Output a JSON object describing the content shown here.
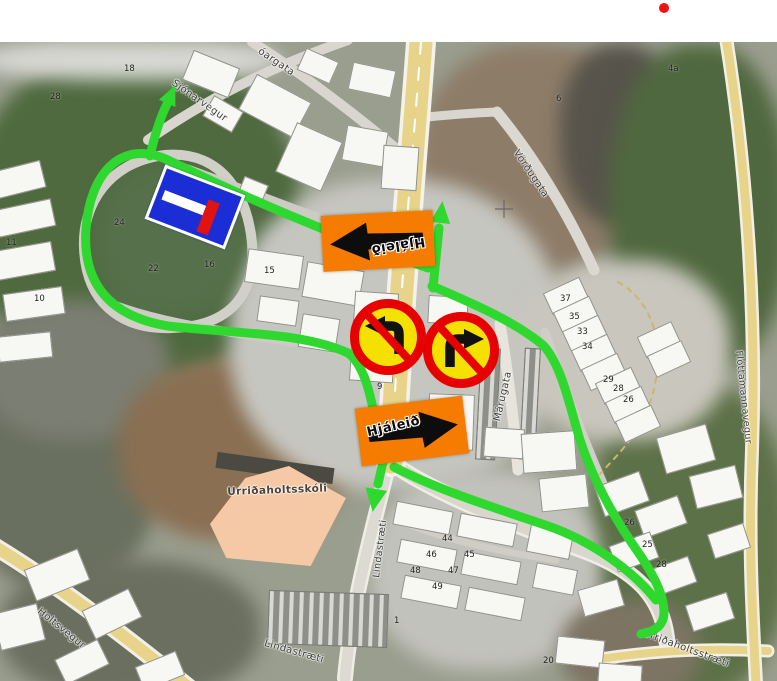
{
  "map_title": "Urriðaholt detour map",
  "colors": {
    "route_green": "#2fd82f",
    "road_yellow": "#e7d48a",
    "sign_orange": "#f57c00",
    "prohibition_yellow": "#f5e100",
    "prohibition_red": "#e60000",
    "dead_end_blue": "#1b2ed6",
    "dead_end_red": "#e01212",
    "school_fill": "#f6c9a6",
    "marker_red": "#ee1111"
  },
  "signs": {
    "detour_label": "Hjáleið",
    "prohibition": [
      {
        "name": "no-left-turn-sign"
      },
      {
        "name": "no-right-turn-sign"
      }
    ],
    "dead_end": {
      "name": "no-through-road-sign"
    }
  },
  "street_labels": [
    {
      "text": "Sjónarvegur",
      "x": 176,
      "y": 78,
      "rot": 35,
      "size": 10
    },
    {
      "text": "óargata",
      "x": 262,
      "y": 46,
      "rot": 34,
      "size": 10
    },
    {
      "text": "Vörðugata",
      "x": 520,
      "y": 148,
      "rot": 56,
      "size": 10
    },
    {
      "text": "Flóttamannavegur",
      "x": 744,
      "y": 350,
      "rot": 84,
      "size": 9.5
    },
    {
      "text": "Márugata",
      "x": 492,
      "y": 420,
      "rot": -77,
      "size": 10
    },
    {
      "text": "Urriðaholtsskóli",
      "x": 227,
      "y": 486,
      "rot": -2,
      "size": 10.5,
      "color": "#4c4238",
      "weight": "bold"
    },
    {
      "text": "Lindastræti",
      "x": 371,
      "y": 577,
      "rot": -83,
      "size": 9.5
    },
    {
      "text": "Lindastræti",
      "x": 266,
      "y": 638,
      "rot": 16,
      "size": 10
    },
    {
      "text": "Holtsvegur",
      "x": 42,
      "y": 606,
      "rot": 39,
      "size": 10
    },
    {
      "text": "Urriðaholtsstræti",
      "x": 645,
      "y": 628,
      "rot": 20,
      "size": 10
    }
  ],
  "building_numbers": [
    {
      "text": "18",
      "x": 124,
      "y": 64
    },
    {
      "text": "28",
      "x": 50,
      "y": 92
    },
    {
      "text": "24",
      "x": 114,
      "y": 218
    },
    {
      "text": "22",
      "x": 148,
      "y": 264
    },
    {
      "text": "16",
      "x": 204,
      "y": 260
    },
    {
      "text": "15",
      "x": 264,
      "y": 266
    },
    {
      "text": "11",
      "x": 6,
      "y": 238
    },
    {
      "text": "10",
      "x": 34,
      "y": 294
    },
    {
      "text": "4a",
      "x": 668,
      "y": 64
    },
    {
      "text": "6",
      "x": 556,
      "y": 94
    },
    {
      "text": "9",
      "x": 377,
      "y": 382
    },
    {
      "text": "18",
      "x": 449,
      "y": 406
    },
    {
      "text": "37",
      "x": 560,
      "y": 294
    },
    {
      "text": "35",
      "x": 569,
      "y": 312
    },
    {
      "text": "33",
      "x": 577,
      "y": 327
    },
    {
      "text": "34",
      "x": 582,
      "y": 342
    },
    {
      "text": "29",
      "x": 603,
      "y": 375
    },
    {
      "text": "28",
      "x": 613,
      "y": 384
    },
    {
      "text": "26",
      "x": 623,
      "y": 395
    },
    {
      "text": "44",
      "x": 442,
      "y": 534
    },
    {
      "text": "46",
      "x": 426,
      "y": 550
    },
    {
      "text": "48",
      "x": 410,
      "y": 566
    },
    {
      "text": "45",
      "x": 464,
      "y": 550
    },
    {
      "text": "47",
      "x": 448,
      "y": 566
    },
    {
      "text": "49",
      "x": 432,
      "y": 582
    },
    {
      "text": "26",
      "x": 624,
      "y": 518
    },
    {
      "text": "25",
      "x": 642,
      "y": 540
    },
    {
      "text": "28",
      "x": 656,
      "y": 560
    },
    {
      "text": "20",
      "x": 543,
      "y": 656
    },
    {
      "text": "1",
      "x": 394,
      "y": 616
    }
  ]
}
